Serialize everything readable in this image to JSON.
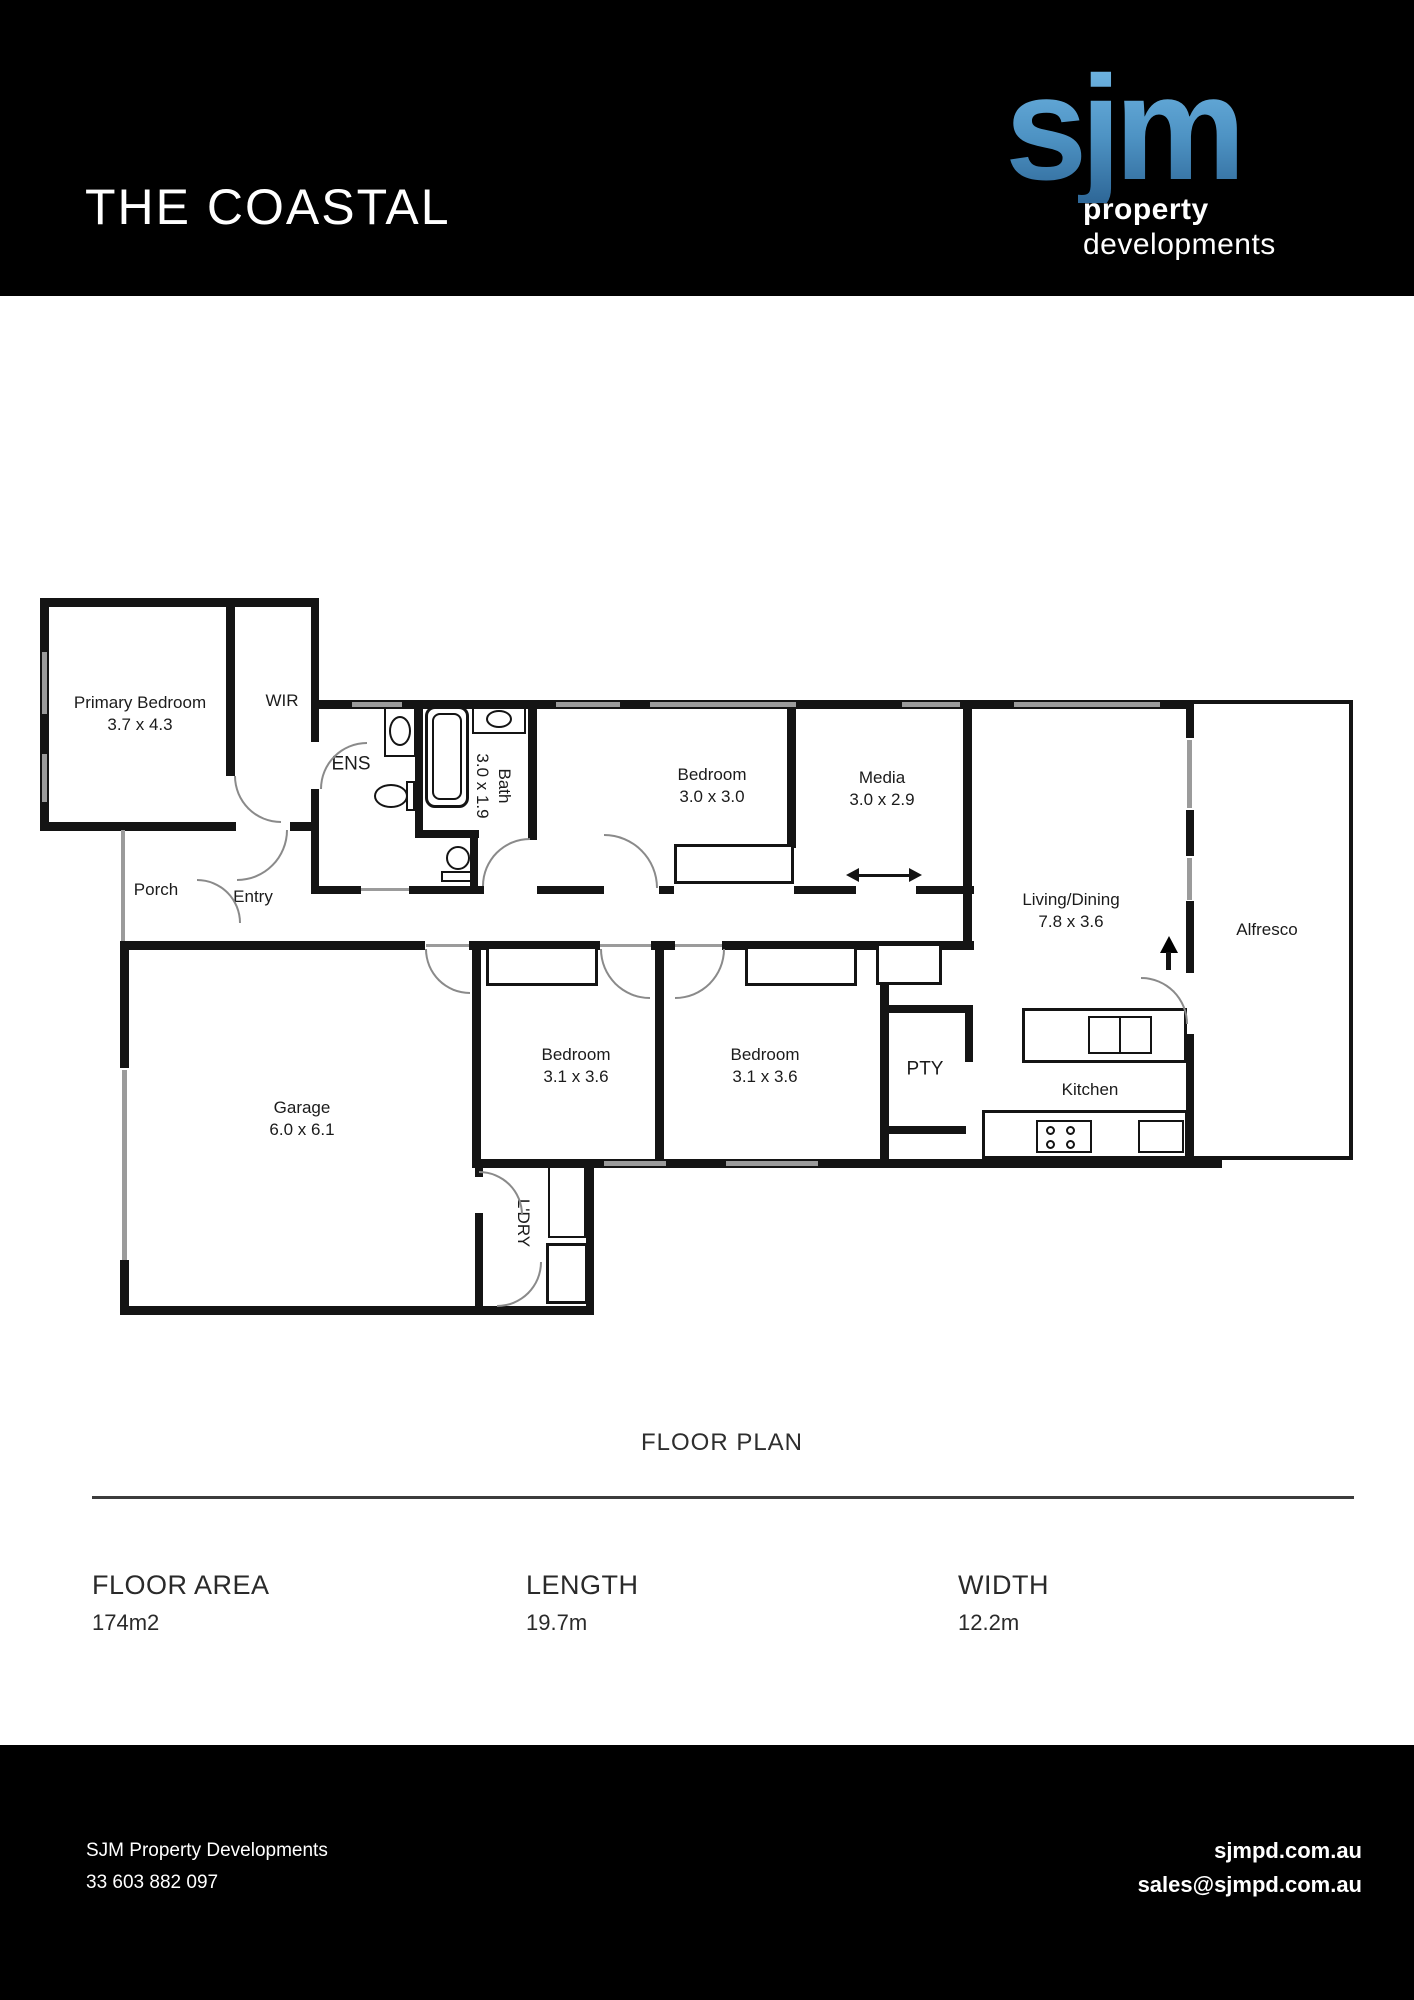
{
  "header": {
    "title": "THE COASTAL",
    "logo": {
      "mark": "sjm",
      "line1": "property",
      "line2": "developments"
    }
  },
  "floor_plan": {
    "caption": "FLOOR PLAN",
    "rooms": {
      "primary_bedroom": {
        "name": "Primary Bedroom",
        "dims": "3.7 x 4.3"
      },
      "wir": {
        "name": "WIR"
      },
      "ens": {
        "name": "ENS"
      },
      "bath": {
        "name": "Bath",
        "dims": "3.0 x 1.9"
      },
      "bedroom3": {
        "name": "Bedroom",
        "dims": "3.0 x 3.0"
      },
      "media": {
        "name": "Media",
        "dims": "3.0 x 2.9"
      },
      "robe_top": {
        "name": "Robe"
      },
      "living_dining": {
        "name": "Living/Dining",
        "dims": "7.8 x 3.6"
      },
      "alfresco": {
        "name": "Alfresco"
      },
      "porch": {
        "name": "Porch"
      },
      "entry": {
        "name": "Entry"
      },
      "lin_hall": {
        "name": "LIN"
      },
      "robe_left": {
        "name": "Robe"
      },
      "robe_right": {
        "name": "Robe"
      },
      "bedroom_left": {
        "name": "Bedroom",
        "dims": "3.1 x 3.6"
      },
      "bedroom_right": {
        "name": "Bedroom",
        "dims": "3.1 x 3.6"
      },
      "pty": {
        "name": "PTY"
      },
      "kitchen": {
        "name": "Kitchen"
      },
      "garage": {
        "name": "Garage",
        "dims": "6.0 x 6.1"
      },
      "ldry": {
        "name": "L'DRY"
      },
      "lin_bottom": {
        "name": "LIN"
      }
    }
  },
  "specs": {
    "items": [
      {
        "label": "FLOOR AREA",
        "value": "174m2"
      },
      {
        "label": "LENGTH",
        "value": "19.7m"
      },
      {
        "label": "WIDTH",
        "value": "12.2m"
      }
    ]
  },
  "footer": {
    "company": "SJM Property Developments",
    "phone": "33 603 882 097",
    "website": "sjmpd.com.au",
    "email": "sales@sjmpd.com.au"
  },
  "colors": {
    "band_bg": "#000000",
    "logo_blue_top": "#74bae7",
    "logo_blue_bottom": "#2e6797",
    "wall": "#141414",
    "window": "#9b9b9b"
  }
}
